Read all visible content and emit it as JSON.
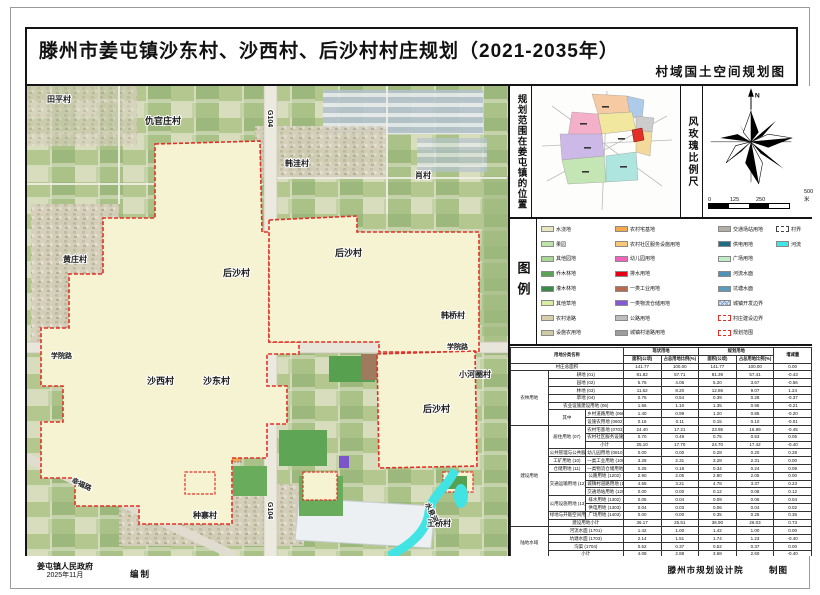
{
  "title": {
    "main": "滕州市姜屯镇沙东村、沙西村、后沙村村庄规划（2021-2035年）",
    "sub": "村域国土空间规划图"
  },
  "panel": {
    "location_caption": "规划范围在姜屯镇的位置",
    "windrose_caption": "风玫瑰比例尺",
    "legend_caption": "图例",
    "north_label": "N"
  },
  "scalebar": {
    "l0": "0",
    "l1": "125",
    "l2": "250",
    "l3": "500米"
  },
  "legend": {
    "columns": [
      [
        {
          "label": "水浇地",
          "color": "#e9e7c2"
        },
        {
          "label": "果园",
          "color": "#bfe3a8"
        },
        {
          "label": "其他园地",
          "color": "#a9d895"
        },
        {
          "label": "乔木林地",
          "color": "#5aa357"
        },
        {
          "label": "灌木林地",
          "color": "#3c8a49"
        },
        {
          "label": "其他草地",
          "color": "#d9eda2"
        },
        {
          "label": "农村道路",
          "color": "#d8cfae"
        },
        {
          "label": "设施农用地",
          "color": "#cfc9a4"
        }
      ],
      [
        {
          "label": "农村宅基地",
          "color": "#f3a94e"
        },
        {
          "label": "农村社区服务设施用地",
          "color": "#f8c979"
        },
        {
          "label": "幼儿园用地",
          "color": "#ef63bb"
        },
        {
          "label": "排水用地",
          "color": "#e60014"
        },
        {
          "label": "一类工业用地",
          "color": "#b66a50"
        },
        {
          "label": "一类物流仓储用地",
          "color": "#8459d2"
        },
        {
          "label": "公路用地",
          "color": "#bdbdbd"
        },
        {
          "label": "城镇村道路用地",
          "color": "#9d9d9d"
        }
      ],
      [
        {
          "label": "交通场站用地",
          "color": "#b3afa7"
        },
        {
          "label": "供电用地",
          "color": "#1e6e86"
        },
        {
          "label": "广场用地",
          "color": "#bfeec6"
        },
        {
          "label": "河流水面",
          "color": "#4e92b8"
        },
        {
          "label": "坑塘水面",
          "color": "#5a9cc0"
        },
        {
          "label": "城镇开发边界",
          "style": "hatch"
        },
        {
          "label": "村庄建设边界",
          "style": "dashred"
        },
        {
          "label": "规划范围",
          "style": "dashredbold"
        }
      ],
      [
        {
          "label": "村界",
          "style": "dashgray"
        },
        {
          "label": "河流",
          "color": "#3fe6e6"
        }
      ]
    ]
  },
  "table": {
    "head": [
      [
        {
          "t": "用地分类名称",
          "cs": 3,
          "rs": 2
        },
        {
          "t": "现状用地",
          "cs": 2
        },
        {
          "t": "规划用地",
          "cs": 2
        },
        {
          "t": "增减量",
          "rs": 2
        }
      ],
      [
        {
          "t": "面积(公顷)"
        },
        {
          "t": "占总用地比例(%)"
        },
        {
          "t": "面积(公顷)"
        },
        {
          "t": "占总用地比例(%)"
        }
      ]
    ],
    "rows": [
      [
        {
          "t": "村庄总面积",
          "cs": 3
        },
        "141.77",
        "100.00",
        "141.77",
        "100.00",
        "0.00"
      ],
      [
        {
          "t": "农林用地",
          "rs": 7
        },
        {
          "t": "耕地 (01)",
          "cs": 2
        },
        "81.82",
        "57.71",
        "81.39",
        "57.41",
        "-0.43"
      ],
      [
        {
          "t": "园地 (02)",
          "cs": 2
        },
        "5.76",
        "4.06",
        "5.20",
        "3.67",
        "-0.56"
      ],
      [
        {
          "t": "林地 (03)",
          "cs": 2
        },
        "11.62",
        "8.20",
        "12.86",
        "9.07",
        "1.24"
      ],
      [
        {
          "t": "草地 (04)",
          "cs": 2
        },
        "0.76",
        "0.54",
        "0.39",
        "0.28",
        "-0.37"
      ],
      [
        {
          "t": "农业设施建设用地 (06)",
          "cs": 2
        },
        "1.56",
        "1.10",
        "1.35",
        "0.95",
        "-0.21"
      ],
      [
        {
          "t": "其中",
          "rs": 2
        },
        {
          "t": "乡村道路用地 (0601)"
        },
        "1.40",
        "0.99",
        "1.20",
        "0.85",
        "-0.20"
      ],
      [
        {
          "t": "设施农用地 (0602)"
        },
        "0.16",
        "0.11",
        "0.15",
        "0.10",
        "-0.01"
      ],
      [
        {
          "t": "建设用地",
          "rs": 13
        },
        {
          "t": "居住用地 (07)",
          "rs": 3
        },
        {
          "t": "农村宅基地 (0703)"
        },
        "24.40",
        "17.21",
        "23.95",
        "16.89",
        "-0.45"
      ],
      [
        {
          "t": "农村社区服务设施用地 (0704)"
        },
        "0.70",
        "0.49",
        "0.75",
        "0.53",
        "0.05"
      ],
      [
        {
          "t": "小计"
        },
        "25.10",
        "17.70",
        "24.70",
        "17.42",
        "-0.40"
      ],
      [
        {
          "t": "公共管理与公共服务用地 (08)"
        },
        {
          "t": "幼儿园用地 (0810)"
        },
        "0.00",
        "0.00",
        "0.28",
        "0.20",
        "0.28"
      ],
      [
        {
          "t": "工矿用地 (10)"
        },
        {
          "t": "一类工业用地 (1001)"
        },
        "3.28",
        "2.31",
        "3.28",
        "2.31",
        "0.00"
      ],
      [
        {
          "t": "仓储用地 (11)"
        },
        {
          "t": "一类物流仓储用地 (1101)"
        },
        "0.25",
        "0.18",
        "0.34",
        "0.24",
        "0.09"
      ],
      [
        {
          "t": "交通运输用地 (12)",
          "rs": 3
        },
        {
          "t": "公路用地 (1202)"
        },
        "2.90",
        "2.05",
        "2.90",
        "2.05",
        "0.00"
      ],
      [
        {
          "t": "城镇村道路用地 (1207)"
        },
        "4.55",
        "3.21",
        "4.78",
        "3.37",
        "0.23"
      ],
      [
        {
          "t": "交通场站用地 (1208)"
        },
        "0.00",
        "0.00",
        "0.12",
        "0.08",
        "0.12"
      ],
      [
        {
          "t": "公用设施用地 (13)",
          "rs": 2
        },
        {
          "t": "排水用地 (1302)"
        },
        "0.05",
        "0.04",
        "0.09",
        "0.06",
        "0.04"
      ],
      [
        {
          "t": "供电用地 (1303)"
        },
        "0.04",
        "0.03",
        "0.06",
        "0.04",
        "0.02"
      ],
      [
        {
          "t": "绿地与开敞空间用地 (14)"
        },
        {
          "t": "广场用地 (1403)"
        },
        "0.00",
        "0.00",
        "0.35",
        "0.25",
        "0.35"
      ],
      [
        {
          "t": "建设用地小计",
          "cs": 2
        },
        "36.17",
        "25.51",
        "36.90",
        "26.03",
        "0.73"
      ],
      [
        {
          "t": "陆地水域",
          "rs": 4
        },
        {
          "t": "河流水面 (1701)",
          "cs": 2
        },
        "1.42",
        "1.00",
        "1.42",
        "1.00",
        "0.00"
      ],
      [
        {
          "t": "坑塘水面 (1703)",
          "cs": 2
        },
        "2.14",
        "1.51",
        "1.74",
        "1.23",
        "-0.40"
      ],
      [
        {
          "t": "沟渠 (1704)",
          "cs": 2
        },
        "0.52",
        "0.37",
        "0.52",
        "0.37",
        "0.00"
      ],
      [
        {
          "t": "小计",
          "cs": 2
        },
        "4.08",
        "2.88",
        "3.68",
        "2.60",
        "-0.40"
      ],
      [
        {
          "t": "其中：村庄建设用地 (07+08+10+11+12+13+14)",
          "cs": 3
        },
        "31.50",
        "22.22",
        "31.93",
        "22.52",
        "0.43"
      ]
    ]
  },
  "map": {
    "labels": [
      {
        "t": "田平村",
        "x": 20,
        "y": 16,
        "s": 8
      },
      {
        "t": "仇官庄村",
        "x": 118,
        "y": 38,
        "s": 9
      },
      {
        "t": "韩洼村",
        "x": 258,
        "y": 80,
        "s": 8
      },
      {
        "t": "肖村",
        "x": 388,
        "y": 92,
        "s": 8
      },
      {
        "t": "黄庄村",
        "x": 36,
        "y": 176,
        "s": 8
      },
      {
        "t": "后沙村",
        "x": 196,
        "y": 190,
        "s": 9
      },
      {
        "t": "后沙村",
        "x": 308,
        "y": 170,
        "s": 9
      },
      {
        "t": "后沙村",
        "x": 396,
        "y": 326,
        "s": 9
      },
      {
        "t": "沙西村",
        "x": 120,
        "y": 298,
        "s": 9
      },
      {
        "t": "沙东村",
        "x": 176,
        "y": 298,
        "s": 9
      },
      {
        "t": "小河圈村",
        "x": 432,
        "y": 291,
        "s": 8
      },
      {
        "t": "韩桥村",
        "x": 414,
        "y": 232,
        "s": 8
      },
      {
        "t": "学院路",
        "x": 420,
        "y": 263,
        "s": 7
      },
      {
        "t": "学院路",
        "x": 24,
        "y": 272,
        "s": 7
      },
      {
        "t": "种寨村",
        "x": 166,
        "y": 432,
        "s": 8
      },
      {
        "t": "王桥村",
        "x": 400,
        "y": 440,
        "s": 8
      },
      {
        "t": "G104",
        "x": 241,
        "y": 24,
        "s": 7,
        "r": 90
      },
      {
        "t": "G104",
        "x": 241,
        "y": 416,
        "s": 7,
        "r": 90
      },
      {
        "t": "水泉河",
        "x": 398,
        "y": 418,
        "s": 7,
        "r": 65
      },
      {
        "t": "幸福路",
        "x": 44,
        "y": 396,
        "s": 7,
        "r": 25
      }
    ]
  },
  "credits": {
    "left_org": "姜屯镇人民政府",
    "left_date": "2025年11月",
    "left_role": "编制",
    "right_org": "滕州市规划设计院",
    "right_role": "制图"
  }
}
